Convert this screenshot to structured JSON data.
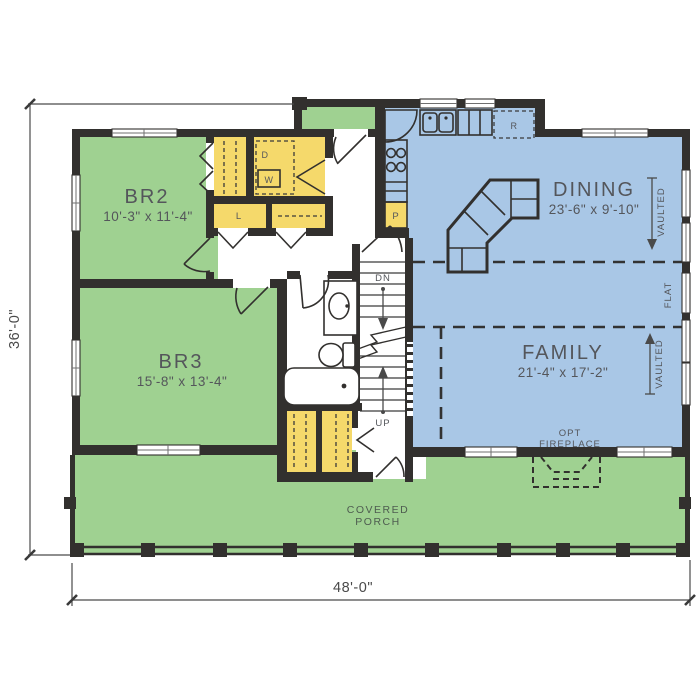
{
  "plan_type": "floor-plan",
  "rooms": [
    {
      "name": "BR2",
      "dims": "10'-3\" x 11'-4\""
    },
    {
      "name": "BR3",
      "dims": "15'-8\" x 13'-4\""
    },
    {
      "name": "DINING",
      "dims": "23'-6\" x 9'-10\""
    },
    {
      "name": "FAMILY",
      "dims": "21'-4\" x 17'-2\""
    }
  ],
  "porch": {
    "line1": "COVERED",
    "line2": "PORCH"
  },
  "fireplace": {
    "line1": "OPT",
    "line2": "FIREPLACE"
  },
  "ceiling": {
    "vaulted_dining": "VAULTED",
    "flat": "FLAT",
    "vaulted_family": "VAULTED"
  },
  "stairs": {
    "down": "DN",
    "up": "UP"
  },
  "fixtures": {
    "dryer": "D",
    "washer": "W",
    "linen": "L",
    "pantry": "P",
    "refrigerator": "R"
  },
  "dimensions": {
    "overall_width": "48'-0\"",
    "overall_depth": "36'-0\""
  },
  "colors": {
    "wall": "#32302e",
    "bedroom_green": "#9fd191",
    "living_blue": "#a9c7e6",
    "closet_yellow": "#f5d96b",
    "porch_green": "#9fd191",
    "label_grey": "#54565b"
  }
}
